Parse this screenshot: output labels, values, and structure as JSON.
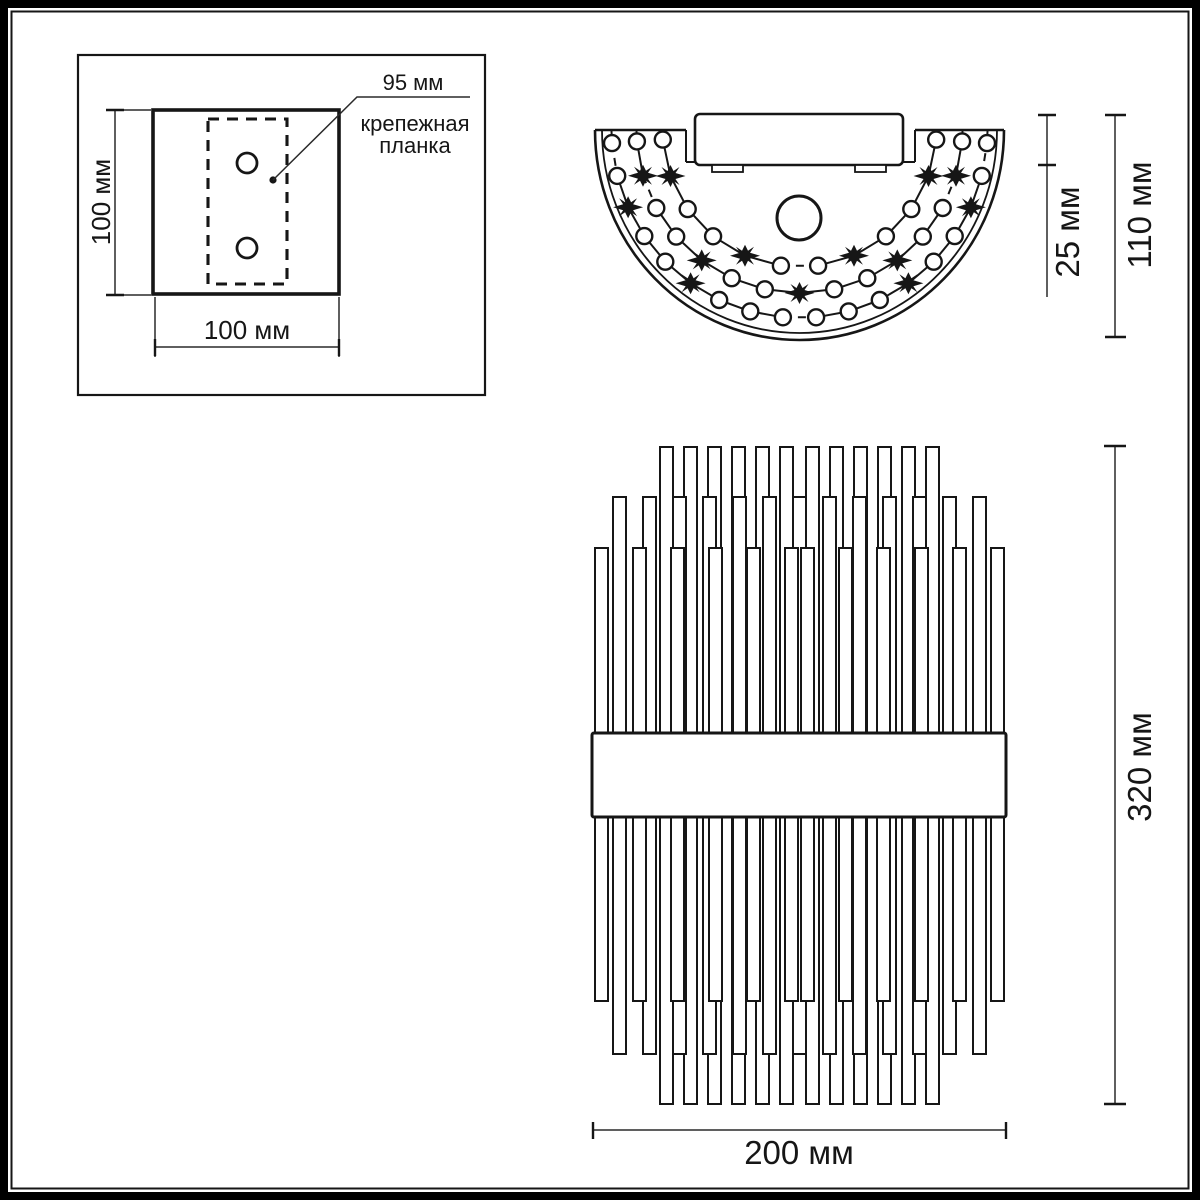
{
  "diagram": {
    "mounting_plate_view": {
      "bracket_width_label": "95 мм",
      "bracket_name_line1": "крепежная",
      "bracket_name_line2": "планка",
      "height_label": "100 мм",
      "width_label": "100 мм"
    },
    "top_view": {
      "box_depth_label": "25 мм",
      "total_depth_label": "110 мм"
    },
    "front_view": {
      "height_label": "320 мм",
      "width_label": "200 мм"
    }
  },
  "colors": {
    "line": "#161616",
    "background": "#ffffff"
  }
}
